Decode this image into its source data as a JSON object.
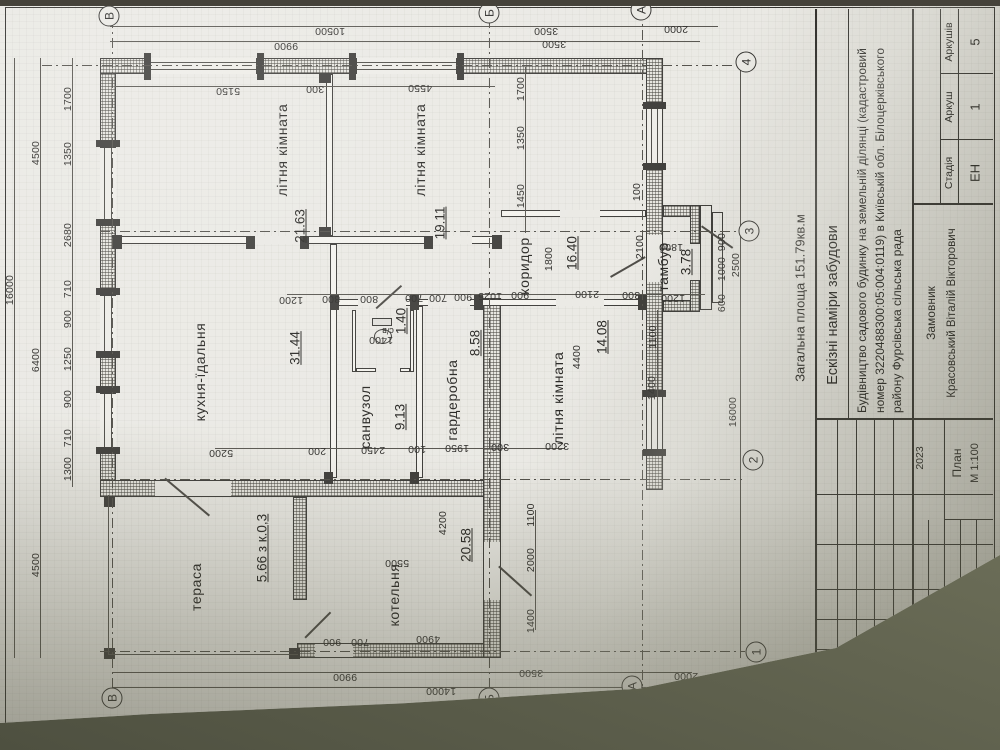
{
  "colors": {
    "paper": "#eae9e4",
    "line": "#3a3936",
    "table": "#6d6f59"
  },
  "summary": {
    "total_area": "Загальна площа 151.79кв.м",
    "x": 452,
    "y": 800
  },
  "rooms": [
    {
      "label": "тераса",
      "area": "5.66 з к.0,3",
      "lx": 163,
      "ly": 196,
      "ax": 202,
      "ay": 262
    },
    {
      "label": "котельня",
      "area": "20.58",
      "lx": 155,
      "ly": 394,
      "ax": 205,
      "ay": 466
    },
    {
      "label": "кухня-їдальня",
      "area": "31.44",
      "lx": 378,
      "ly": 200,
      "ax": 402,
      "ay": 295
    },
    {
      "label": "літня кімната",
      "area": "21.63",
      "lx": 600,
      "ly": 282,
      "ax": 524,
      "ay": 300
    },
    {
      "label": "літня кімната",
      "area": "19.11",
      "lx": 600,
      "ly": 420,
      "ax": 527,
      "ay": 440
    },
    {
      "label": "санвузол",
      "area": "9.13",
      "lx": 333,
      "ly": 365,
      "ax": 333,
      "ay": 400
    },
    {
      "label": "гардеробна",
      "area": "8.58",
      "lx": 350,
      "ly": 452,
      "ax": 407,
      "ay": 475
    },
    {
      "label": "коридор",
      "area": "16.40",
      "lx": 484,
      "ly": 524,
      "ax": 497,
      "ay": 572
    },
    {
      "label": "літня кімната",
      "area": "14.08",
      "lx": 352,
      "ly": 558,
      "ax": 413,
      "ay": 602
    },
    {
      "label": "тамбур",
      "area": "3.78",
      "lx": 483,
      "ly": 663,
      "ax": 488,
      "ay": 686
    },
    {
      "label": "с/в",
      "area": "1.40",
      "lx": 419,
      "ly": 388,
      "ax": 429,
      "ay": 401,
      "small": true,
      "label_rot": 1
    }
  ],
  "dimensions": [
    {
      "t": "16000",
      "x": 460,
      "y": 10
    },
    {
      "t": "4500",
      "x": 185,
      "y": 36
    },
    {
      "t": "6400",
      "x": 390,
      "y": 36
    },
    {
      "t": "4500",
      "x": 597,
      "y": 36
    },
    {
      "t": "1300",
      "x": 281,
      "y": 68
    },
    {
      "t": "710",
      "x": 312,
      "y": 68
    },
    {
      "t": "900",
      "x": 351,
      "y": 68
    },
    {
      "t": "1250",
      "x": 391,
      "y": 68
    },
    {
      "t": "900",
      "x": 431,
      "y": 68
    },
    {
      "t": "710",
      "x": 461,
      "y": 68
    },
    {
      "t": "2680",
      "x": 515,
      "y": 68
    },
    {
      "t": "1350",
      "x": 596,
      "y": 68
    },
    {
      "t": "1700",
      "x": 651,
      "y": 68
    },
    {
      "t": "10500",
      "x": 719,
      "y": 330,
      "r": 1
    },
    {
      "t": "3500",
      "x": 719,
      "y": 546,
      "r": 1
    },
    {
      "t": "2000",
      "x": 721,
      "y": 676,
      "r": 1
    },
    {
      "t": "9900",
      "x": 704,
      "y": 286,
      "r": 1
    },
    {
      "t": "3500",
      "x": 706,
      "y": 554,
      "r": 1
    },
    {
      "t": "5150",
      "x": 659,
      "y": 228,
      "r": 1
    },
    {
      "t": "300",
      "x": 661,
      "y": 315,
      "r": 1
    },
    {
      "t": "4550",
      "x": 662,
      "y": 420,
      "r": 1
    },
    {
      "t": "14000",
      "x": 59,
      "y": 441,
      "r": 1
    },
    {
      "t": "9900",
      "x": 73,
      "y": 345,
      "r": 1
    },
    {
      "t": "3500",
      "x": 77,
      "y": 531,
      "r": 1
    },
    {
      "t": "2000",
      "x": 74,
      "y": 686,
      "r": 1
    },
    {
      "t": "900",
      "x": 108,
      "y": 332,
      "r": 1
    },
    {
      "t": "700",
      "x": 108,
      "y": 360,
      "r": 1
    },
    {
      "t": "4900",
      "x": 111,
      "y": 428,
      "r": 1
    },
    {
      "t": "1200",
      "x": 450,
      "y": 291,
      "r": 1
    },
    {
      "t": "800",
      "x": 451,
      "y": 331,
      "r": 1
    },
    {
      "t": "800",
      "x": 451,
      "y": 369,
      "r": 1
    },
    {
      "t": "700",
      "x": 452,
      "y": 414,
      "r": 1
    },
    {
      "t": "700",
      "x": 452,
      "y": 438,
      "r": 1
    },
    {
      "t": "900",
      "x": 453,
      "y": 463,
      "r": 1
    },
    {
      "t": "1025",
      "x": 454,
      "y": 490,
      "r": 1
    },
    {
      "t": "900",
      "x": 455,
      "y": 520,
      "r": 1
    },
    {
      "t": "2100",
      "x": 456,
      "y": 587,
      "r": 1
    },
    {
      "t": "300",
      "x": 455,
      "y": 631,
      "r": 1
    },
    {
      "t": "1200",
      "x": 452,
      "y": 673,
      "r": 1
    },
    {
      "t": "5200",
      "x": 297,
      "y": 221,
      "r": 1
    },
    {
      "t": "200",
      "x": 299,
      "y": 317,
      "r": 1
    },
    {
      "t": "2450",
      "x": 300,
      "y": 373,
      "r": 1
    },
    {
      "t": "100",
      "x": 301,
      "y": 417,
      "r": 1
    },
    {
      "t": "1950",
      "x": 302,
      "y": 457,
      "r": 1
    },
    {
      "t": "300",
      "x": 303,
      "y": 500,
      "r": 1
    },
    {
      "t": "3200",
      "x": 304,
      "y": 557,
      "r": 1
    },
    {
      "t": "1450",
      "x": 554,
      "y": 521
    },
    {
      "t": "1350",
      "x": 612,
      "y": 521
    },
    {
      "t": "1700",
      "x": 661,
      "y": 521
    },
    {
      "t": "1800",
      "x": 491,
      "y": 549
    },
    {
      "t": "2100",
      "x": 503,
      "y": 640
    },
    {
      "t": "100",
      "x": 558,
      "y": 637
    },
    {
      "t": "1400",
      "x": 362,
      "y": 652
    },
    {
      "t": "1100",
      "x": 413,
      "y": 653
    },
    {
      "t": "1400",
      "x": 129,
      "y": 531
    },
    {
      "t": "2000",
      "x": 190,
      "y": 531
    },
    {
      "t": "1100",
      "x": 235,
      "y": 531
    },
    {
      "t": "4400",
      "x": 393,
      "y": 577
    },
    {
      "t": "4200",
      "x": 227,
      "y": 443
    },
    {
      "t": "600",
      "x": 447,
      "y": 722
    },
    {
      "t": "1000",
      "x": 481,
      "y": 722
    },
    {
      "t": "900",
      "x": 508,
      "y": 722
    },
    {
      "t": "2500",
      "x": 485,
      "y": 736
    },
    {
      "t": "16000",
      "x": 338,
      "y": 733
    },
    {
      "t": "5500",
      "x": 187,
      "y": 397,
      "r": 1
    },
    {
      "t": "1400",
      "x": 410,
      "y": 381,
      "r": 1
    },
    {
      "t": "1800",
      "x": 503,
      "y": 671,
      "r": 1
    }
  ],
  "axes": {
    "letters": [
      {
        "t": "В",
        "x": 52,
        "y": 112
      },
      {
        "t": "Б",
        "x": 52,
        "y": 489
      },
      {
        "t": "А",
        "x": 64,
        "y": 632
      },
      {
        "t": "В",
        "x": 734,
        "y": 109
      },
      {
        "t": "Б",
        "x": 737,
        "y": 489
      },
      {
        "t": "А",
        "x": 740,
        "y": 641
      }
    ],
    "numbers": [
      {
        "t": "1",
        "x": 98,
        "y": 756
      },
      {
        "t": "2",
        "x": 290,
        "y": 753
      },
      {
        "t": "3",
        "x": 519,
        "y": 749
      },
      {
        "t": "4",
        "x": 688,
        "y": 746
      }
    ]
  },
  "title_block": {
    "sketch_title": "Ескізні наміри забудови",
    "desc1": "Будівництво садового будинку на земельній ділянці (кадастровий",
    "desc2": "номер 3220488300:05:004:0119) в Київській обл. Білоцерківського",
    "desc3": "району Фурсівська сільська рада",
    "stage_label": "Стадія",
    "sheet_label": "Аркуш",
    "sheets_label": "Аркушів",
    "stage_value": "ЕН",
    "sheet_value": "1",
    "sheets_value": "5",
    "client_label": "Замовник",
    "client_name": "Красовський Віталій Вікторович",
    "plan_label": "План",
    "scale_label": "М 1:100",
    "rev_headers": [
      "Зміна",
      "Кільк.",
      "Аркуш",
      "№док.",
      "Підпис",
      "Дата"
    ],
    "date_value": "2023"
  }
}
